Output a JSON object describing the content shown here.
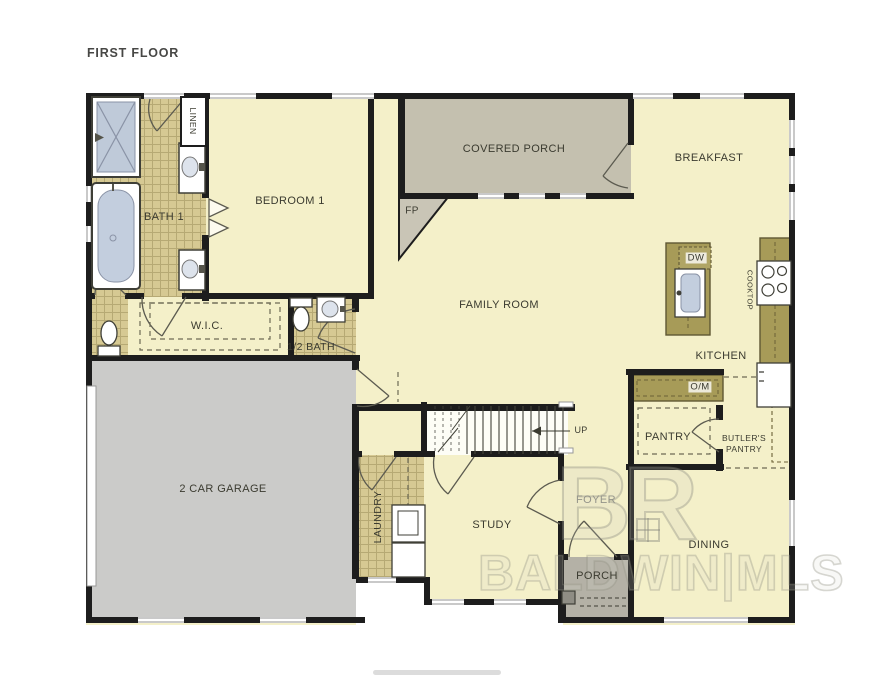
{
  "title": "FIRST FLOOR",
  "rooms": {
    "bath1": "BATH 1",
    "bedroom1": "BEDROOM 1",
    "wic": "W.I.C.",
    "half_bath": "1/2 BATH",
    "covered_porch": "COVERED PORCH",
    "breakfast": "BREAKFAST",
    "family_room": "FAMILY ROOM",
    "kitchen": "KITCHEN",
    "pantry": "PANTRY",
    "butlers_pantry": "BUTLER'S PANTRY",
    "garage": "2 CAR GARAGE",
    "laundry": "LAUNDRY",
    "study": "STUDY",
    "foyer": "FOYER",
    "porch": "PORCH",
    "dining": "DINING"
  },
  "annotations": {
    "linen": "LINEN",
    "fireplace": "FP",
    "stairs_up": "UP",
    "dishwasher": "DW",
    "oven_microwave": "O/M",
    "cooktop": "COOKTOP"
  },
  "watermark": {
    "logo": "BR",
    "text": "BALDWIN|MLS"
  },
  "colors": {
    "floor": "#f4f0c9",
    "tile": "#d6c993",
    "cabinet": "#a79b58",
    "covered_porch": "#c4c0af",
    "front_porch": "#b4b1a6",
    "garage": "#cbcbc9",
    "wall": "#1d1d1d",
    "fixture_blue": "#c3cede",
    "window": "#c9c9c9"
  }
}
